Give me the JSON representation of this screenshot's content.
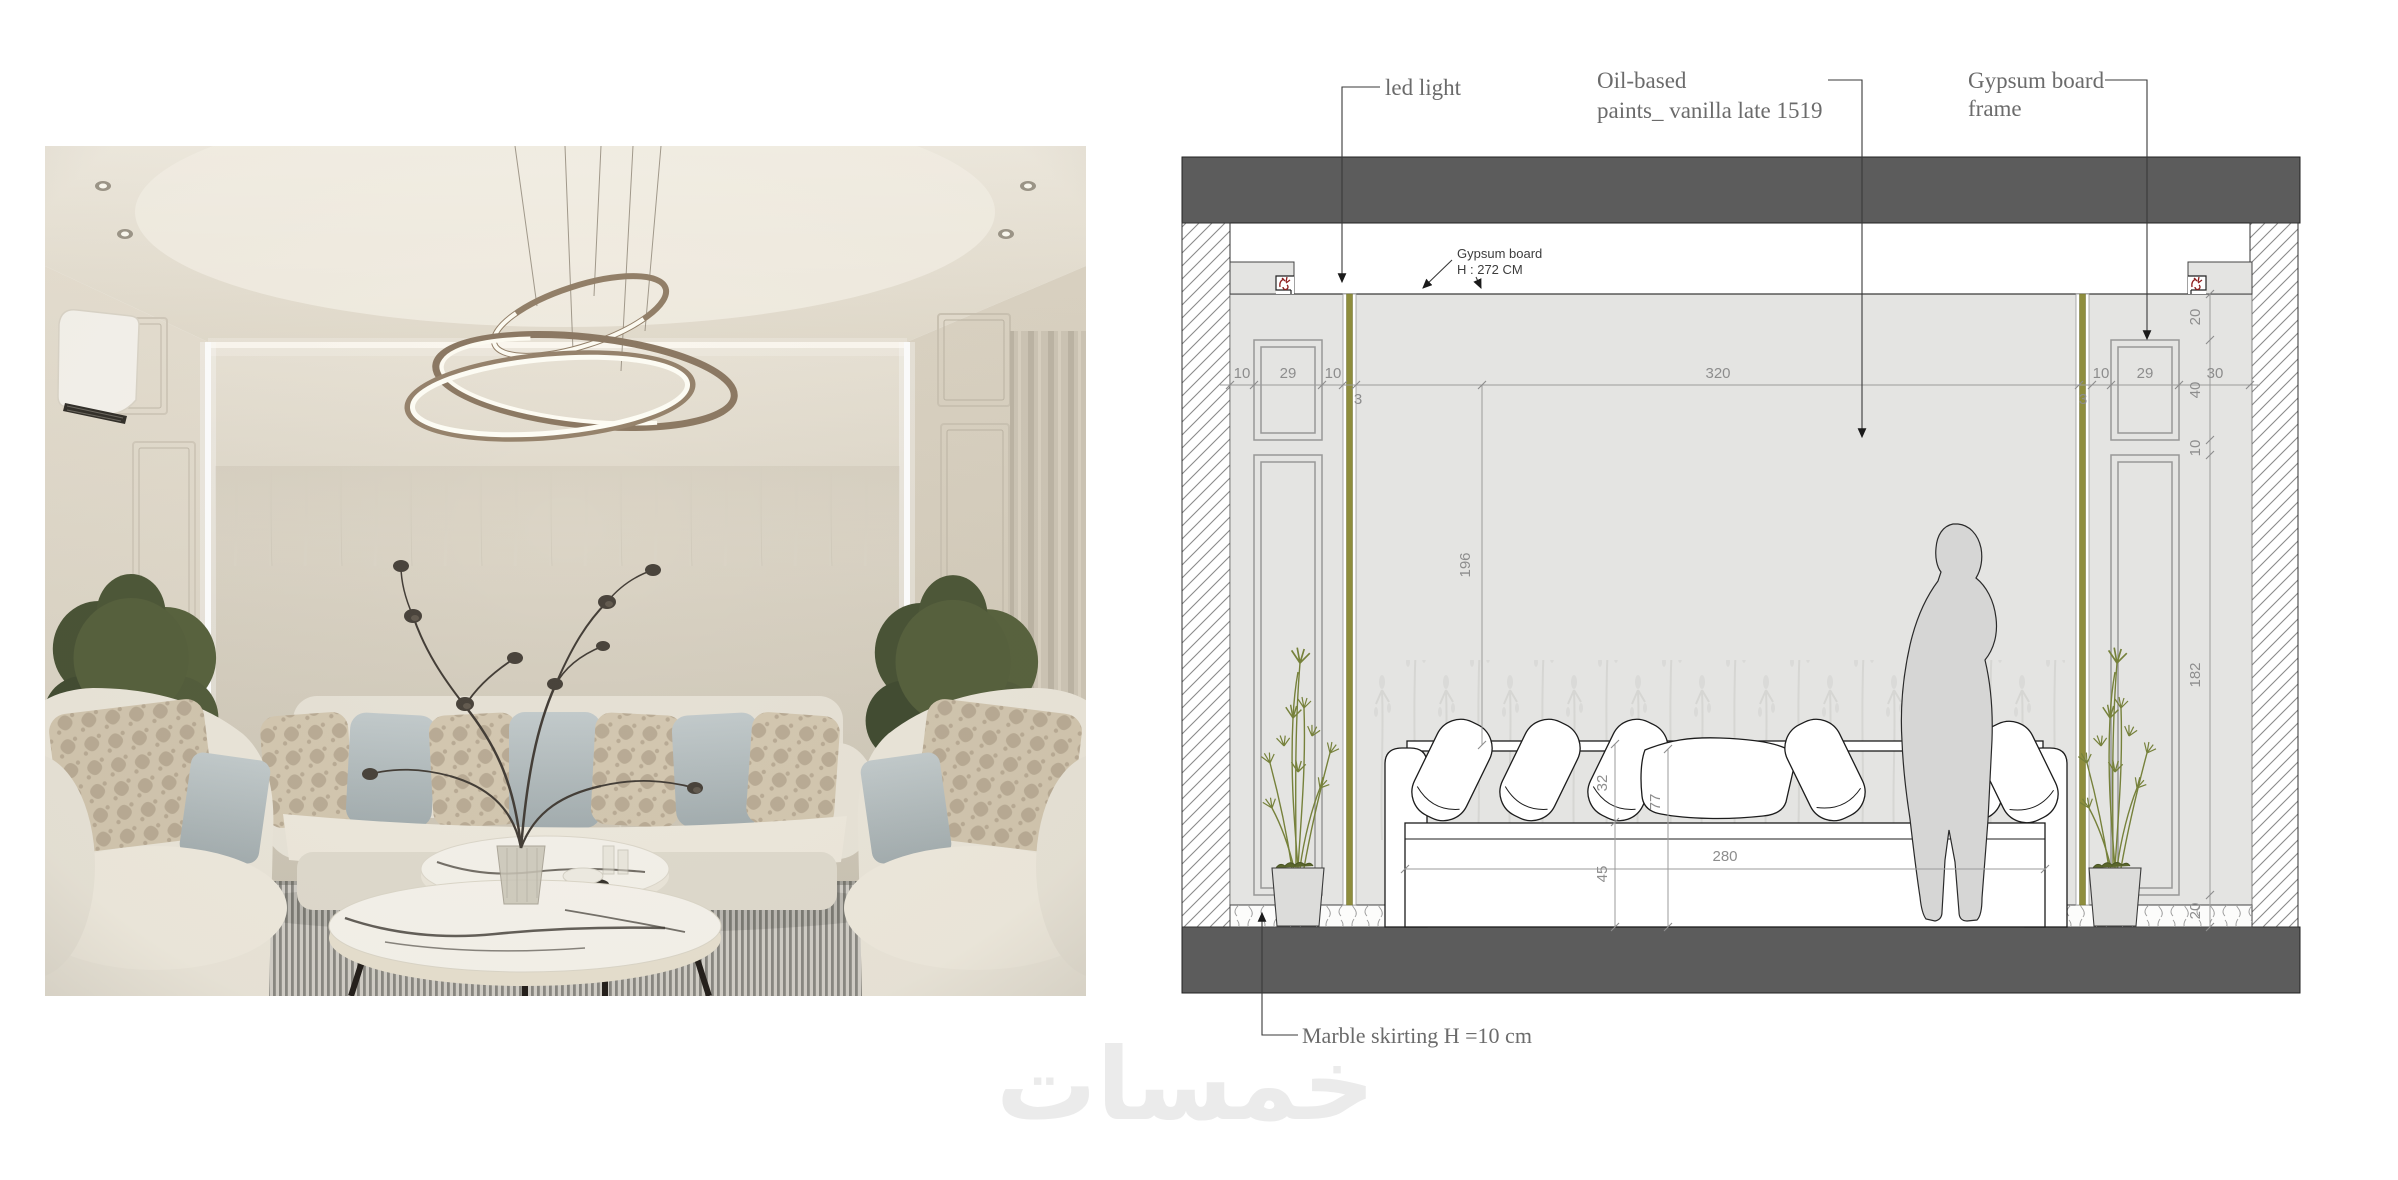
{
  "watermark": "خمسات",
  "drawing": {
    "labels": {
      "led_light": "led light",
      "oil_based_1": "Oil-based",
      "oil_based_2": "paints_ vanilla late 1519",
      "gypsum_frame_1": "Gypsum board",
      "gypsum_frame_2": "frame",
      "gypsum_note_1": "Gypsum board",
      "gypsum_note_2": "H : 272 CM",
      "marble_skirting": "Marble skirting H =10 cm"
    },
    "dims": {
      "wall_width": "320",
      "wall_height_upper": "196",
      "sofa_width": "280",
      "back_cushion_h": "32",
      "sofa_total_h": "77",
      "seat_h": "45",
      "left_10a": "10",
      "left_29": "29",
      "left_10b": "10",
      "left_3": "3",
      "right_10": "10",
      "right_29": "29",
      "right_30": "30",
      "right_3": "3",
      "v_20a": "20",
      "v_40": "40",
      "v_10": "10",
      "v_182": "182",
      "v_20b": "20"
    },
    "colors": {
      "slab_gray": "#5c5c5c",
      "wall_fill": "#e4e4e2",
      "led_strip_olive": "#8e8d3d",
      "light_symbol_red": "#8e1f1f",
      "plant_olive": "#76813b",
      "dim_text": "#8d8d8d",
      "label_text": "#6b6b6b"
    }
  }
}
